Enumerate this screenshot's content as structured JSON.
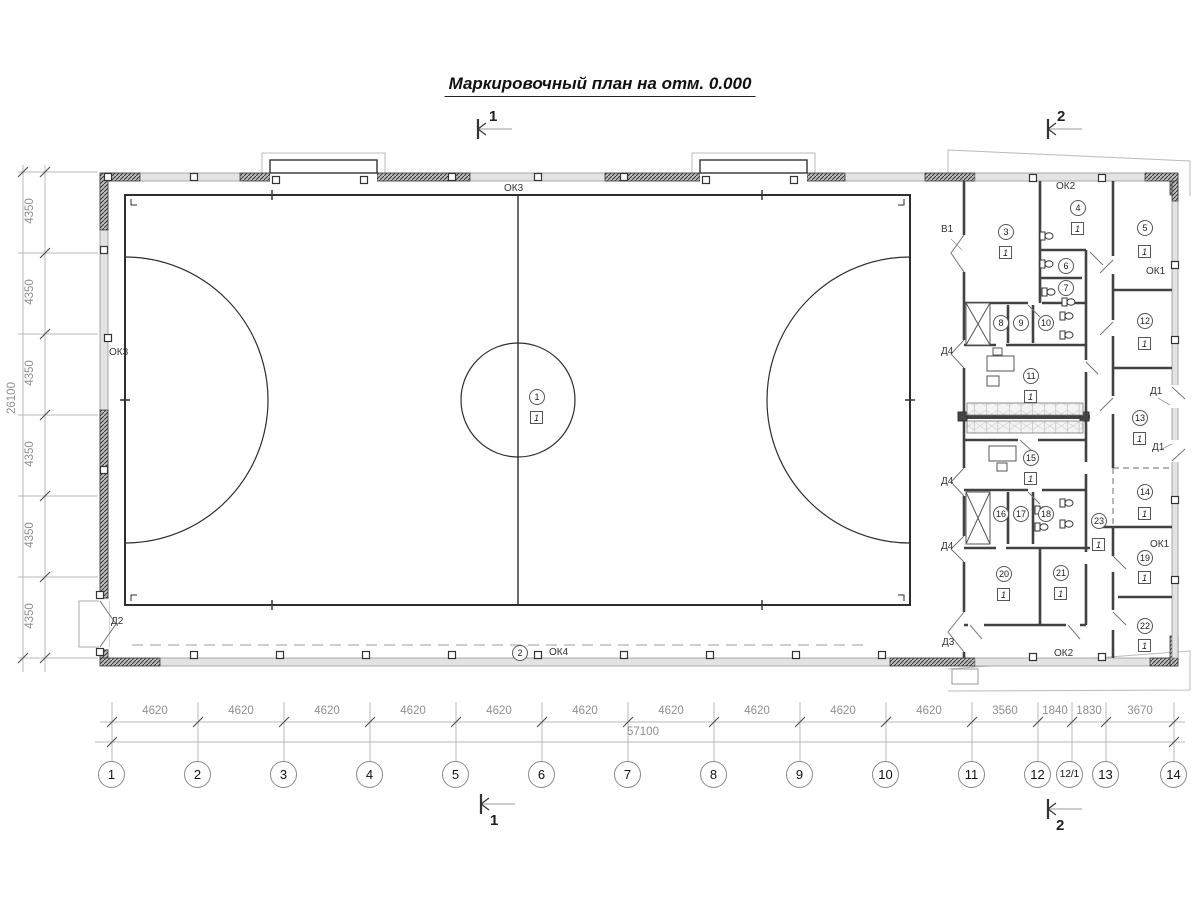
{
  "title": "Маркировочный план на отм. 0.000",
  "floor_mark": "1",
  "rooms": [
    "1",
    "2",
    "3",
    "4",
    "5",
    "6",
    "7",
    "8",
    "9",
    "10",
    "11",
    "12",
    "13",
    "14",
    "15",
    "16",
    "17",
    "18",
    "19",
    "20",
    "21",
    "22",
    "23"
  ],
  "labels": {
    "ok3_top": "ОК3",
    "ok3_left": "ОК3",
    "ok4": "ОК4",
    "ok2_top": "ОК2",
    "ok2_bot": "ОК2",
    "ok1_up": "ОК1",
    "ok1_low": "ОК1",
    "v1": "В1",
    "d1_up": "Д1",
    "d1_low": "Д1",
    "d2": "Д2",
    "d3": "Д3",
    "d4_a": "Д4",
    "d4_b": "Д4",
    "d4_c": "Д4"
  },
  "sections": {
    "top1": "1",
    "top2": "2",
    "bot1": "1",
    "bot2": "2"
  },
  "axes": [
    "1",
    "2",
    "3",
    "4",
    "5",
    "6",
    "7",
    "8",
    "9",
    "10",
    "11",
    "12",
    "12/1",
    "13",
    "14"
  ],
  "dims_bottom": {
    "segments": [
      "4620",
      "4620",
      "4620",
      "4620",
      "4620",
      "4620",
      "4620",
      "4620",
      "4620",
      "4620",
      "3560",
      "1840",
      "1830",
      "3670"
    ],
    "total": "57100"
  },
  "dims_left": {
    "segments": [
      "4350",
      "4350",
      "4350",
      "4350",
      "4350",
      "4350"
    ],
    "total": "26100"
  },
  "colors": {
    "wall_dark": "#3a3a3a",
    "wall_light": "#e3e3e3",
    "dim_line": "#b0b0b0",
    "text": "#333333"
  }
}
